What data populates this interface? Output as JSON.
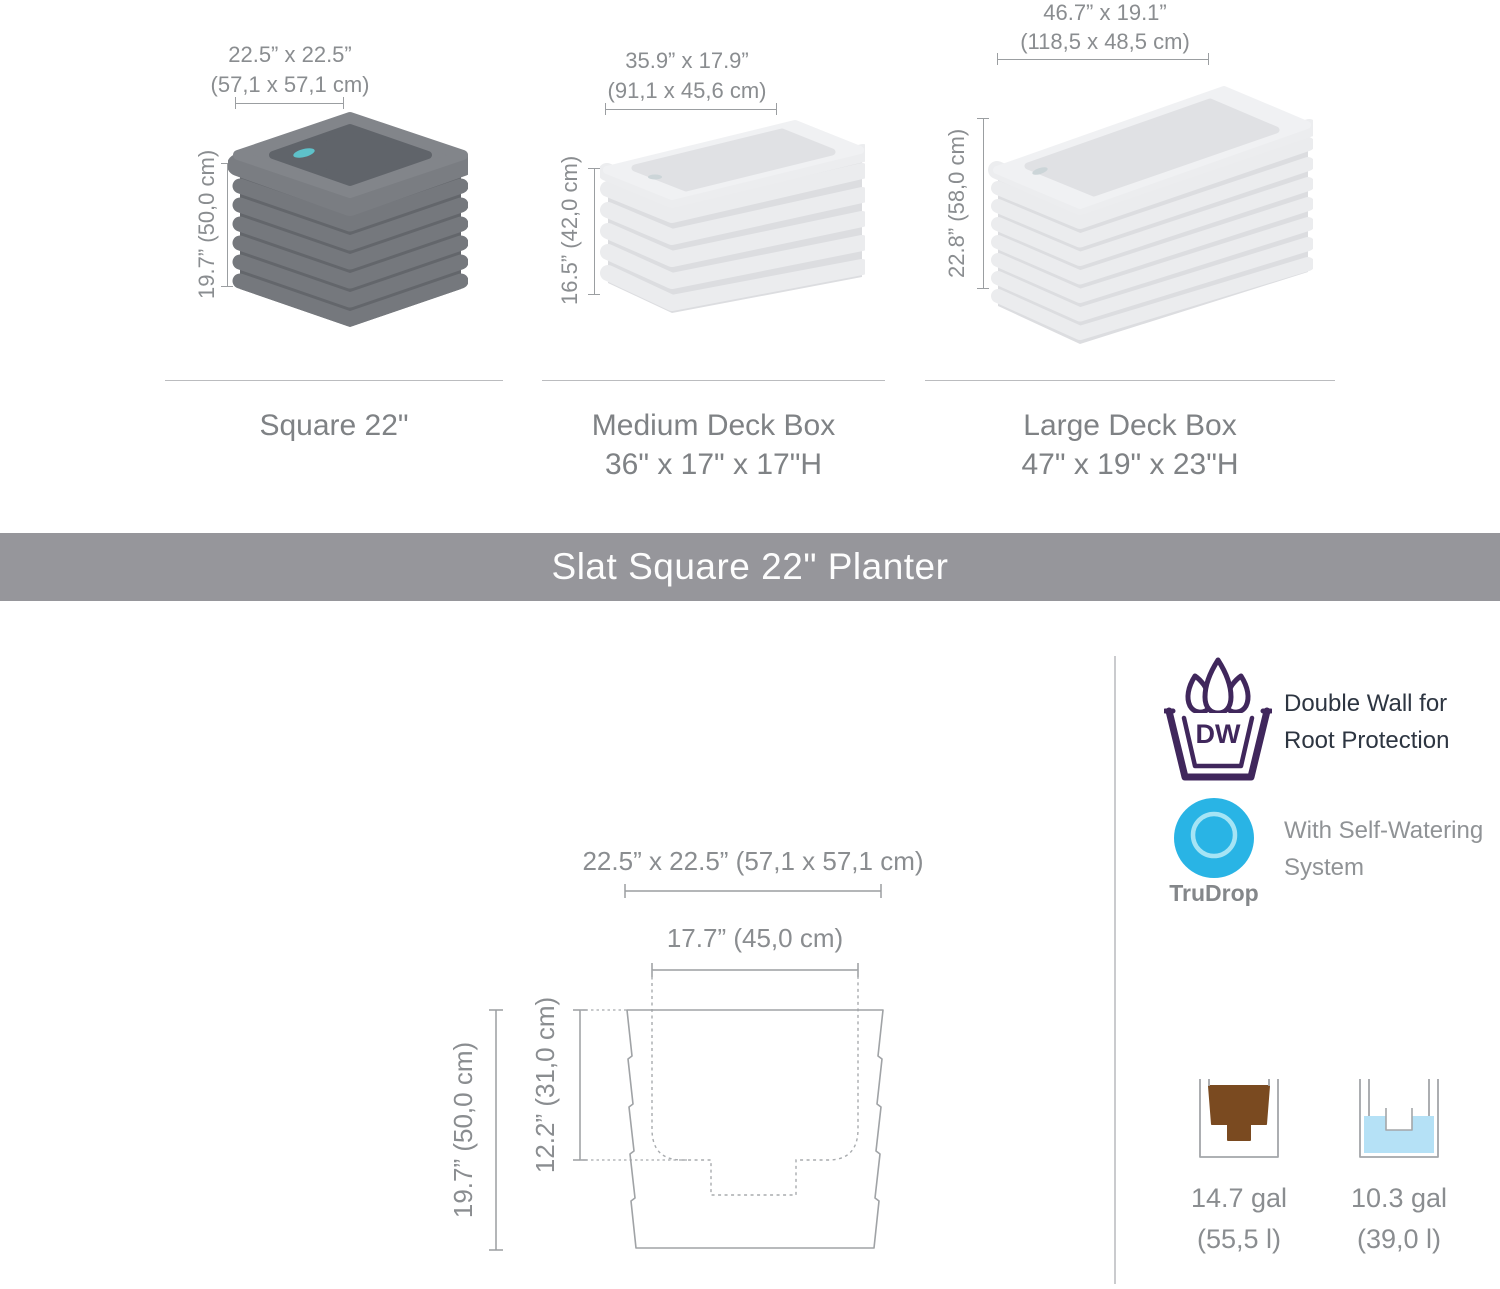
{
  "banner": {
    "title": "Slat Square 22\" Planter"
  },
  "products": [
    {
      "name": "Square 22\"",
      "width_in": "22.5” x 22.5”",
      "width_cm": "(57,1 x 57,1 cm)",
      "height": "19.7” (50,0 cm)"
    },
    {
      "name": "Medium Deck Box",
      "size": "36\" x 17\" x 17\"H",
      "width_in": "35.9” x 17.9”",
      "width_cm": "(91,1 x 45,6 cm)",
      "height": "16.5” (42,0 cm)"
    },
    {
      "name": "Large Deck Box",
      "size": "47\" x 19\" x 23\"H",
      "width_in": "46.7” x 19.1”",
      "width_cm": "(118,5 x 48,5 cm)",
      "height": "22.8” (58,0 cm)"
    }
  ],
  "drawing": {
    "top_width": "22.5” x 22.5” (57,1 x 57,1 cm)",
    "opening_width": "17.7” (45,0 cm)",
    "overall_height": "19.7” (50,0 cm)",
    "inner_depth": "12.2” (31,0 cm)"
  },
  "features": [
    {
      "badge": "DW",
      "line1": "Double Wall for",
      "line2": "Root Protection"
    },
    {
      "badge": "TruDrop",
      "line1": "With Self-Watering",
      "line2": "System"
    }
  ],
  "capacities": [
    {
      "kind": "soil",
      "amount": "14.7 gal",
      "liters": "(55,5 l)"
    },
    {
      "kind": "water",
      "amount": "10.3 gal",
      "liters": "(39,0 l)"
    }
  ],
  "colors": {
    "banner_bg": "#96969b",
    "accent_purple": "#40275c",
    "accent_cyan": "#29b4e5",
    "soil_brown": "#7a4a20",
    "water_blue": "#b5e1f6",
    "planter_dark": "#75787d",
    "planter_light": "#ebecee",
    "dimension_gray": "#8a8d90",
    "dark_text": "#2d3541"
  }
}
